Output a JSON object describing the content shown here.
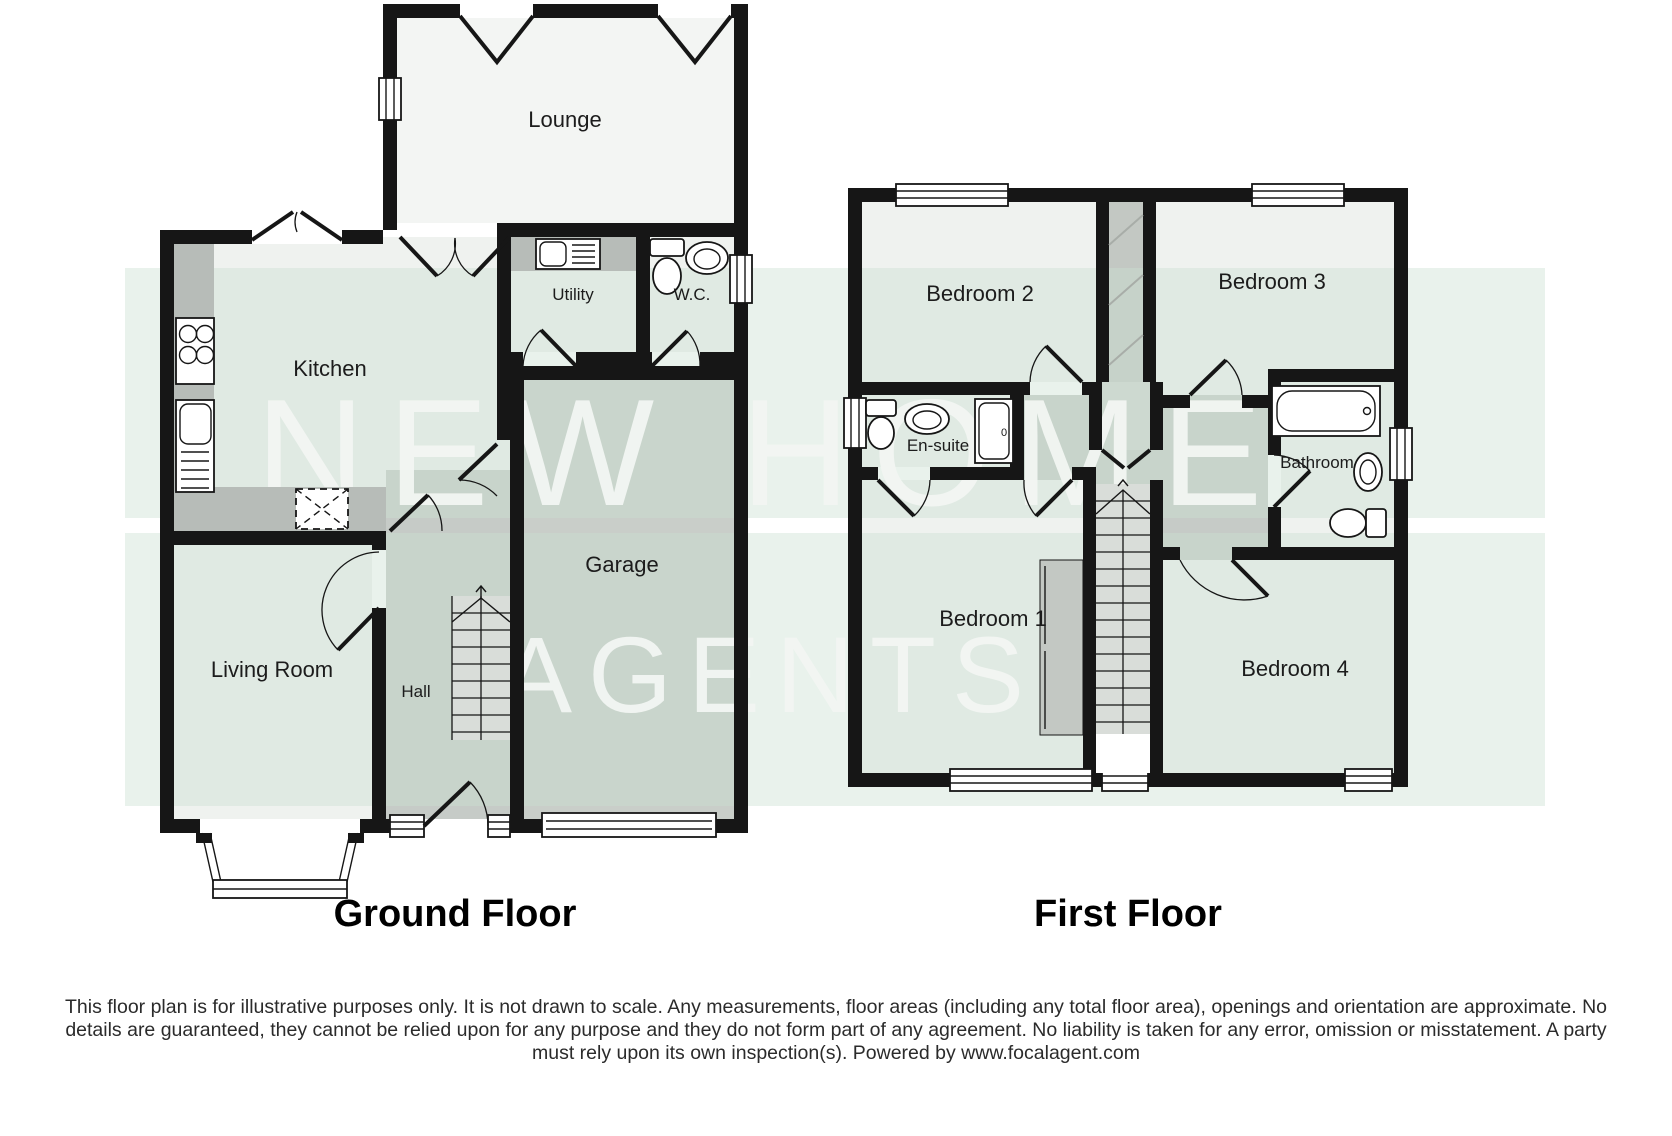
{
  "watermark": {
    "line1": "NEW HOME",
    "line2": "AGENTS"
  },
  "ground_floor": {
    "title": "Ground Floor",
    "rooms": {
      "lounge": "Lounge",
      "kitchen": "Kitchen",
      "utility": "Utility",
      "wc": "W.C.",
      "garage": "Garage",
      "living_room": "Living Room",
      "hall": "Hall"
    }
  },
  "first_floor": {
    "title": "First Floor",
    "rooms": {
      "bedroom1": "Bedroom 1",
      "bedroom2": "Bedroom 2",
      "bedroom3": "Bedroom 3",
      "bedroom4": "Bedroom 4",
      "ensuite": "En-suite",
      "bathroom": "Bathroom"
    }
  },
  "disclaimer": {
    "line1": "This floor plan is for illustrative purposes only. It is not drawn to scale. Any measurements, floor areas (including any total floor area), openings and orientation are approximate. No",
    "line2": "details are guaranteed, they cannot be relied upon for any purpose and they do not form part of any agreement. No liability is taken for any error, omission or misstatement. A party",
    "line3": "must rely upon its own inspection(s). Powered by www.focalagent.com"
  },
  "colors": {
    "wall": "#161616",
    "room_fill": "#eff2ef",
    "gray_fill": "#c6cbc7",
    "counter_fill": "#b7bcb8",
    "stair_fill": "#d9ddd9",
    "watermark_band": "#dcebe1"
  }
}
